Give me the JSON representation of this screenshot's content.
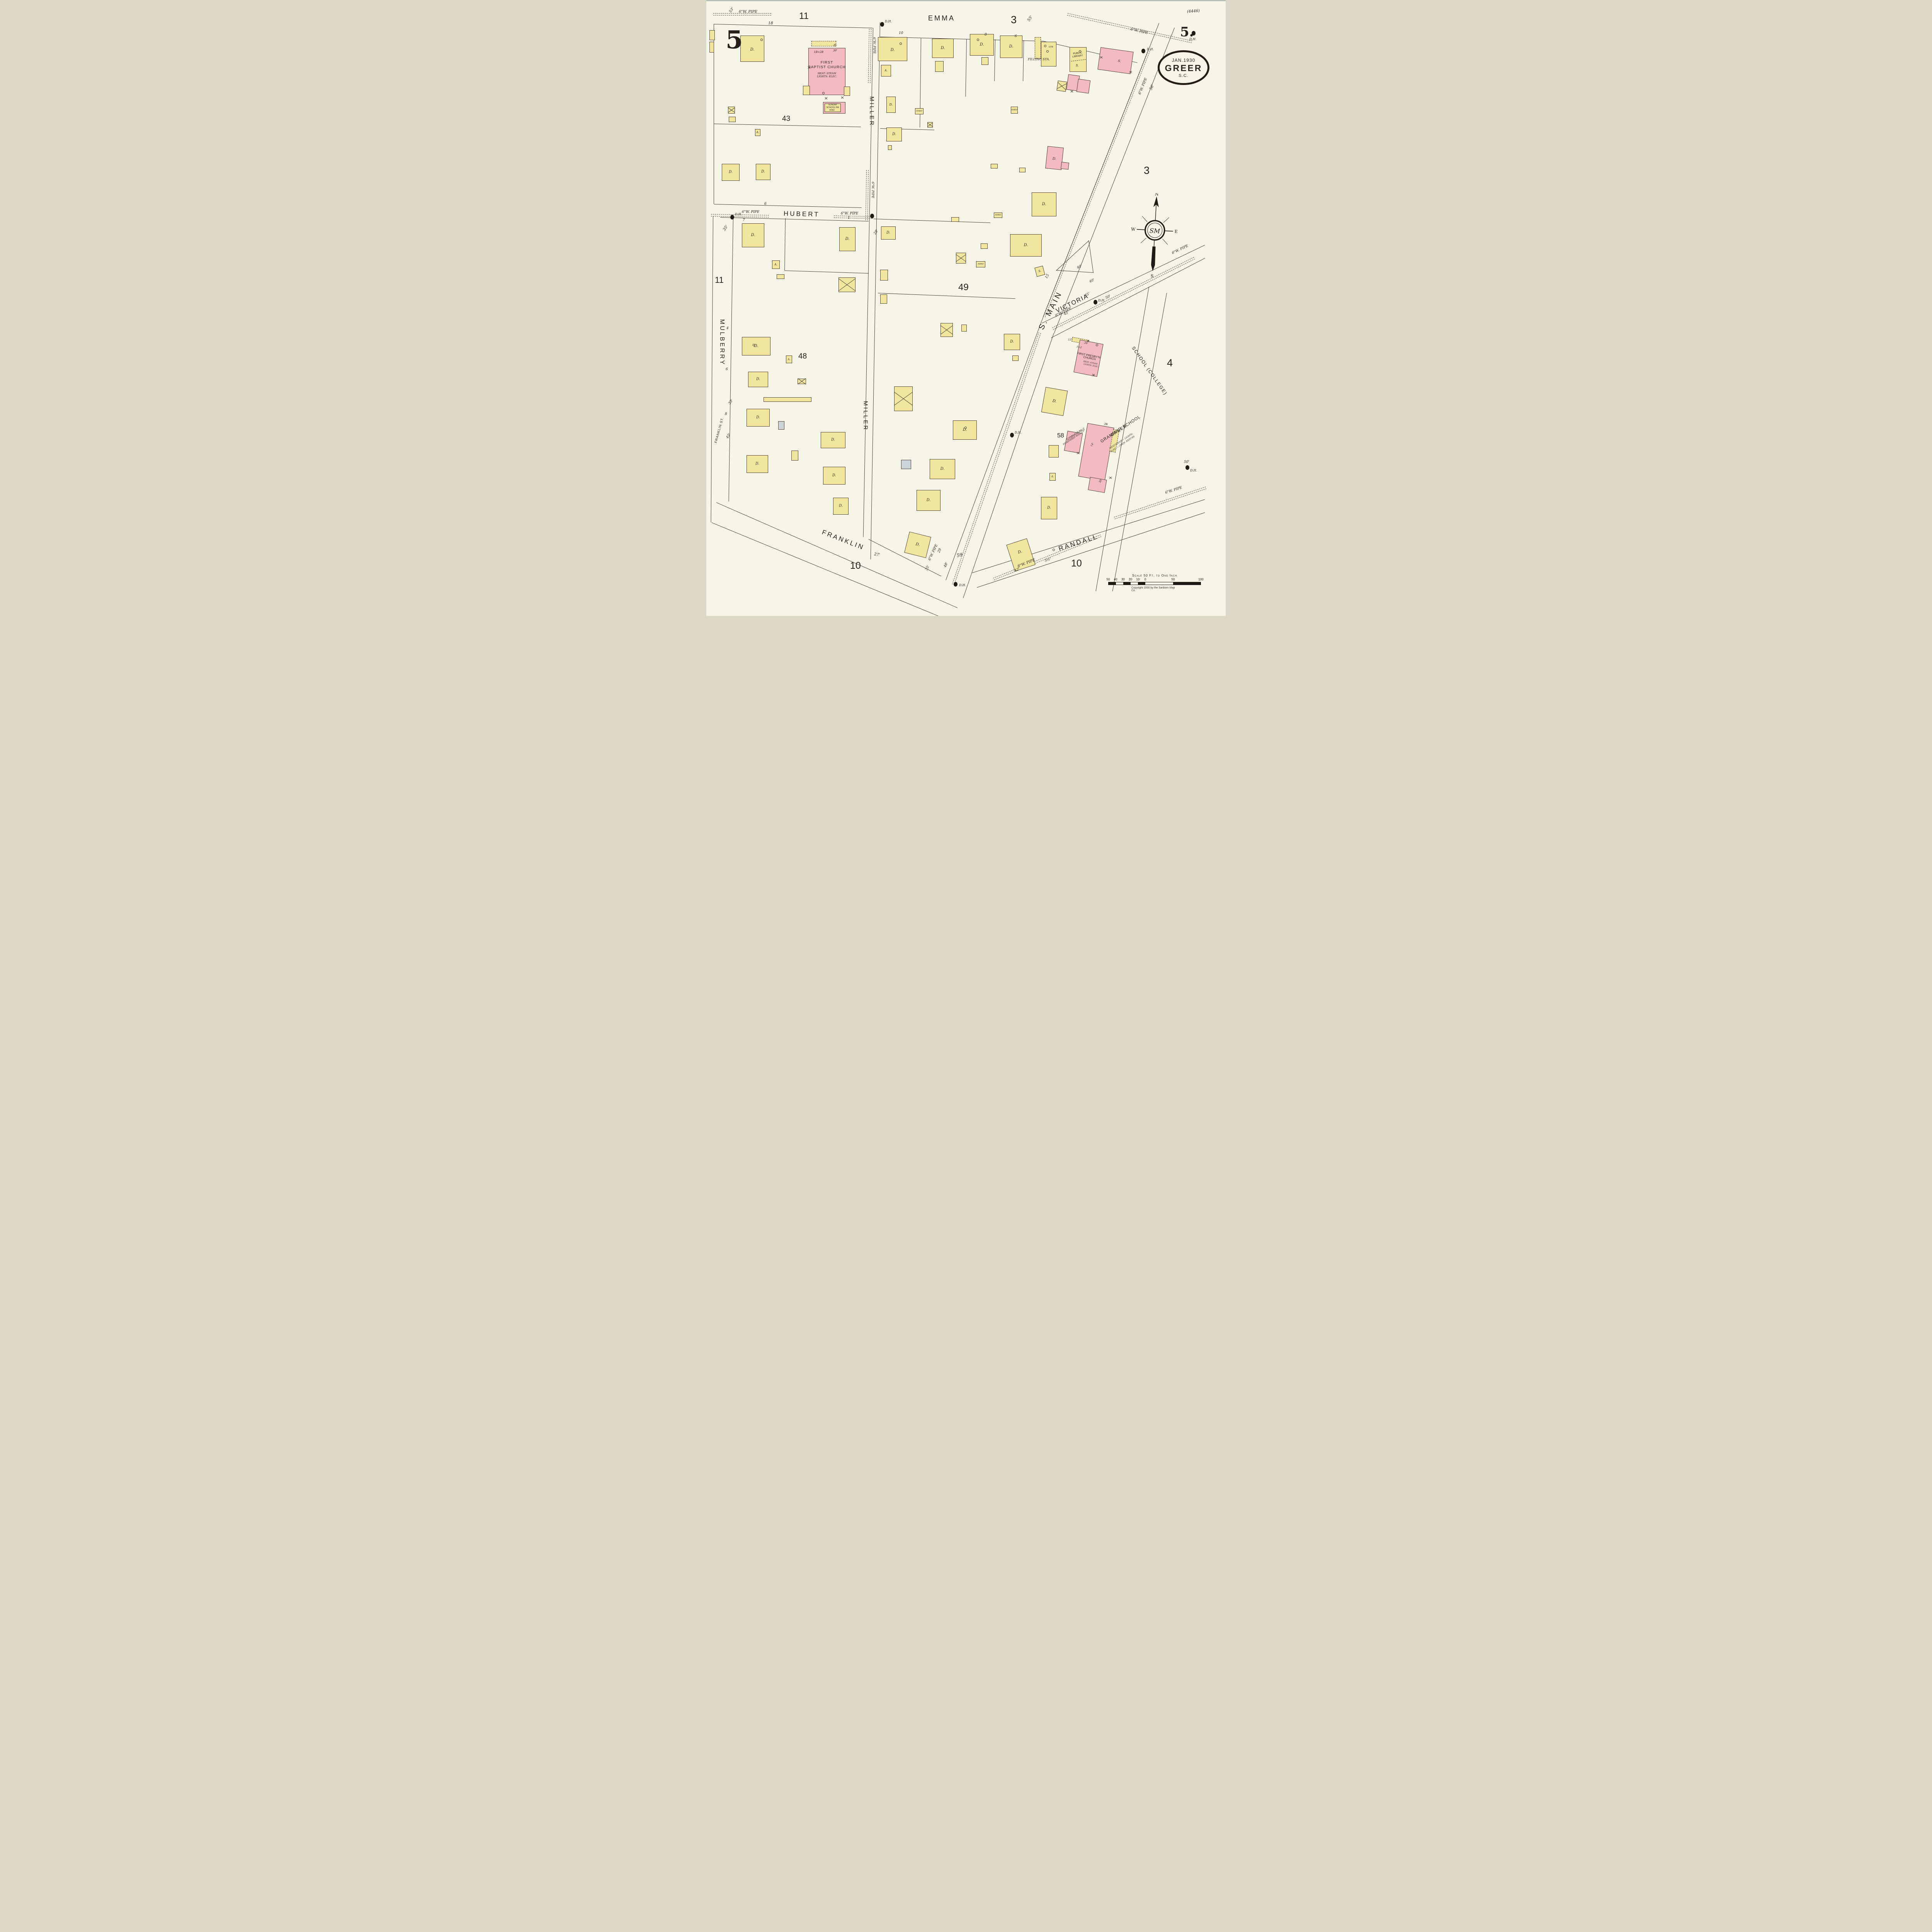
{
  "colors": {
    "paper": "#f7f4e8",
    "frame_yellow": "#f1e5a0",
    "brick_pink": "#f3bac2",
    "special_blue": "#cdd4d8",
    "ink": "#2b2620"
  },
  "sheet": {
    "page_number_top_left": "5",
    "page_number_top_right": "5.",
    "plate_reference": "(4446)"
  },
  "title_block": {
    "date": "JAN.1930",
    "city": "GREER",
    "state": "S.C."
  },
  "compass": {
    "north": "N",
    "east": "E",
    "south": "S",
    "west": "W",
    "monogram": "SM"
  },
  "scale_bar": {
    "caption": "Scale 50 Ft. to One Inch",
    "ticks": [
      "50",
      "40",
      "30",
      "20",
      "10",
      "0",
      "50",
      "100"
    ],
    "copyright": "Copyright 1930 by the Sanborn Map Co."
  },
  "streets": {
    "emma": "EMMA",
    "miller_north": "MILLER",
    "miller_south": "MILLER",
    "hubert": "HUBERT",
    "mulberry": "MULBERRY",
    "franklin": "FRANKLIN",
    "franklin_st": "FRANKLIN ST.",
    "s_main": "S. MAIN",
    "victoria": "VICTORIA",
    "school_college": "SCHOOL (COLLEGE)",
    "randall": "RANDALL"
  },
  "block_numbers": {
    "b11_top": "11",
    "b11_left": "11",
    "b3_top": "3",
    "b3_right": "3",
    "b4": "4",
    "b43": "43",
    "b48": "48",
    "b49": "49",
    "b58": "58",
    "b59": "59",
    "b10_left": "10",
    "b10_right": "10"
  },
  "utilities": {
    "water_pipe_6in": "6\"W. PIPE",
    "water_pipe_8in": "8\"W. PIPE",
    "double_hydrant": "D.H."
  },
  "legend": {
    "dwelling": "D.",
    "auto_garage": "A.",
    "store": "S.",
    "shed": "SHED"
  },
  "buildings": {
    "first_baptist_church": {
      "name_line1": "FIRST",
      "name_line2": "BAPTIST CHURCH",
      "heat": "HEAT: STEAM",
      "lights": "LIGHTS: ELEC.",
      "height_code": "1B=2B",
      "front": "30'"
    },
    "sunday_school": {
      "line1": "SUNDAY",
      "line2": "SCHOOL RM",
      "line3": "VEND"
    },
    "public_library": {
      "line1": "PUBLIC",
      "line2": "LIBRARY"
    },
    "filling_station": {
      "name": "FILLING STA.",
      "tank_note": "GT8"
    },
    "first_presbyterian_church": {
      "name_line1": "FIRST PRESBY'N",
      "name_line2": "CHURCH",
      "heat": "HEAT: STEAM",
      "lights": "LIGHTS: ELEC.",
      "front": "26'",
      "height_code": "1=2",
      "wall": "12\""
    },
    "gymnasium": {
      "name": "GYMNASIUM",
      "note": "PILASTERED WALLS"
    },
    "greer_grammar_school": {
      "name_line1": "GREER",
      "name_line2": "GRAMMAR SCHOOL",
      "note_line1": "HEAT:STEAM ~ LIGHTS:",
      "note_line2": "ELEC. ~ CHEM. EXTG'RS",
      "height_code": "2B",
      "dim_30a": "30'",
      "dim_30b": "30'",
      "dim_14": "14'"
    }
  },
  "dimensions": {
    "d53": "53'",
    "d18": "18",
    "d55": "55'",
    "d56": "56'",
    "d35_hubert": "35'",
    "d28": "28'",
    "n7": "7",
    "n6": "6",
    "n1": "1",
    "h10": "10",
    "h8": "8",
    "h6": "6",
    "m4": "4",
    "m6": "6",
    "m8": "8",
    "d33": "33'",
    "d45_mulberry": "45'",
    "d27": "27'",
    "d40_a": "40'",
    "d40_b": "40'",
    "d45_victoria_a": "45'",
    "d45_victoria_b": "45'",
    "d50_victoria": "50'",
    "d50_school": "50'",
    "n15": "15",
    "n29": "29",
    "d48": "48'",
    "d42": "42'",
    "d35_bottom": "35'",
    "d5h": "5½'"
  }
}
